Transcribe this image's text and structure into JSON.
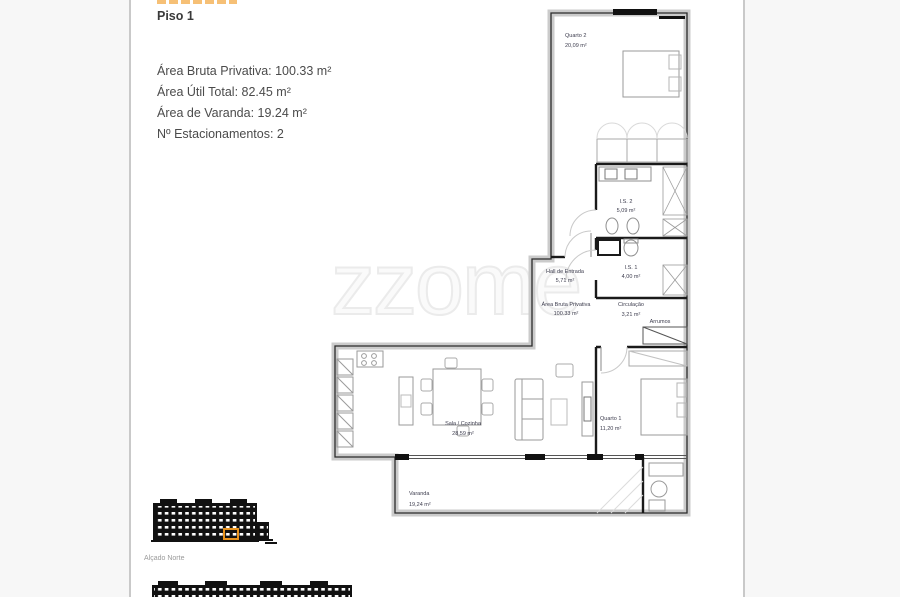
{
  "page": {
    "floor": "Piso 1",
    "specs": [
      "Área Bruta Privativa: 100.33 m²",
      "Área Útil Total: 82.45 m²",
      "Área de Varanda: 19.24 m²",
      "Nº Estacionamentos: 2"
    ],
    "watermark": "zzome"
  },
  "plan": {
    "rooms": {
      "quarto2": {
        "name": "Quarto 2",
        "area": "20,09 m²"
      },
      "is2": {
        "name": "I.S. 2",
        "area": "5,09 m²"
      },
      "is1": {
        "name": "I.S. 1",
        "area": "4,00 m²"
      },
      "hall": {
        "name": "Hall de Entrada",
        "area": "5,71 m²"
      },
      "abp": {
        "name": "Área Bruta Privativa",
        "area": "100.33 m²"
      },
      "circulacao": {
        "name": "Circulação",
        "area": "3,21 m²"
      },
      "arrumos": {
        "name": "Arrumos"
      },
      "sala": {
        "name": "Sala / Cozinha",
        "area": "28,59 m²"
      },
      "quarto1": {
        "name": "Quarto 1",
        "area": "11,20 m²"
      },
      "varanda": {
        "name": "Varanda",
        "area": "19,24 m²"
      }
    }
  },
  "elevations": {
    "north_label": "Alçado Norte"
  },
  "colors": {
    "accent_orange": "#e8921c",
    "wall_gray": "#cbcbcb",
    "ink": "#1a1a1a"
  }
}
